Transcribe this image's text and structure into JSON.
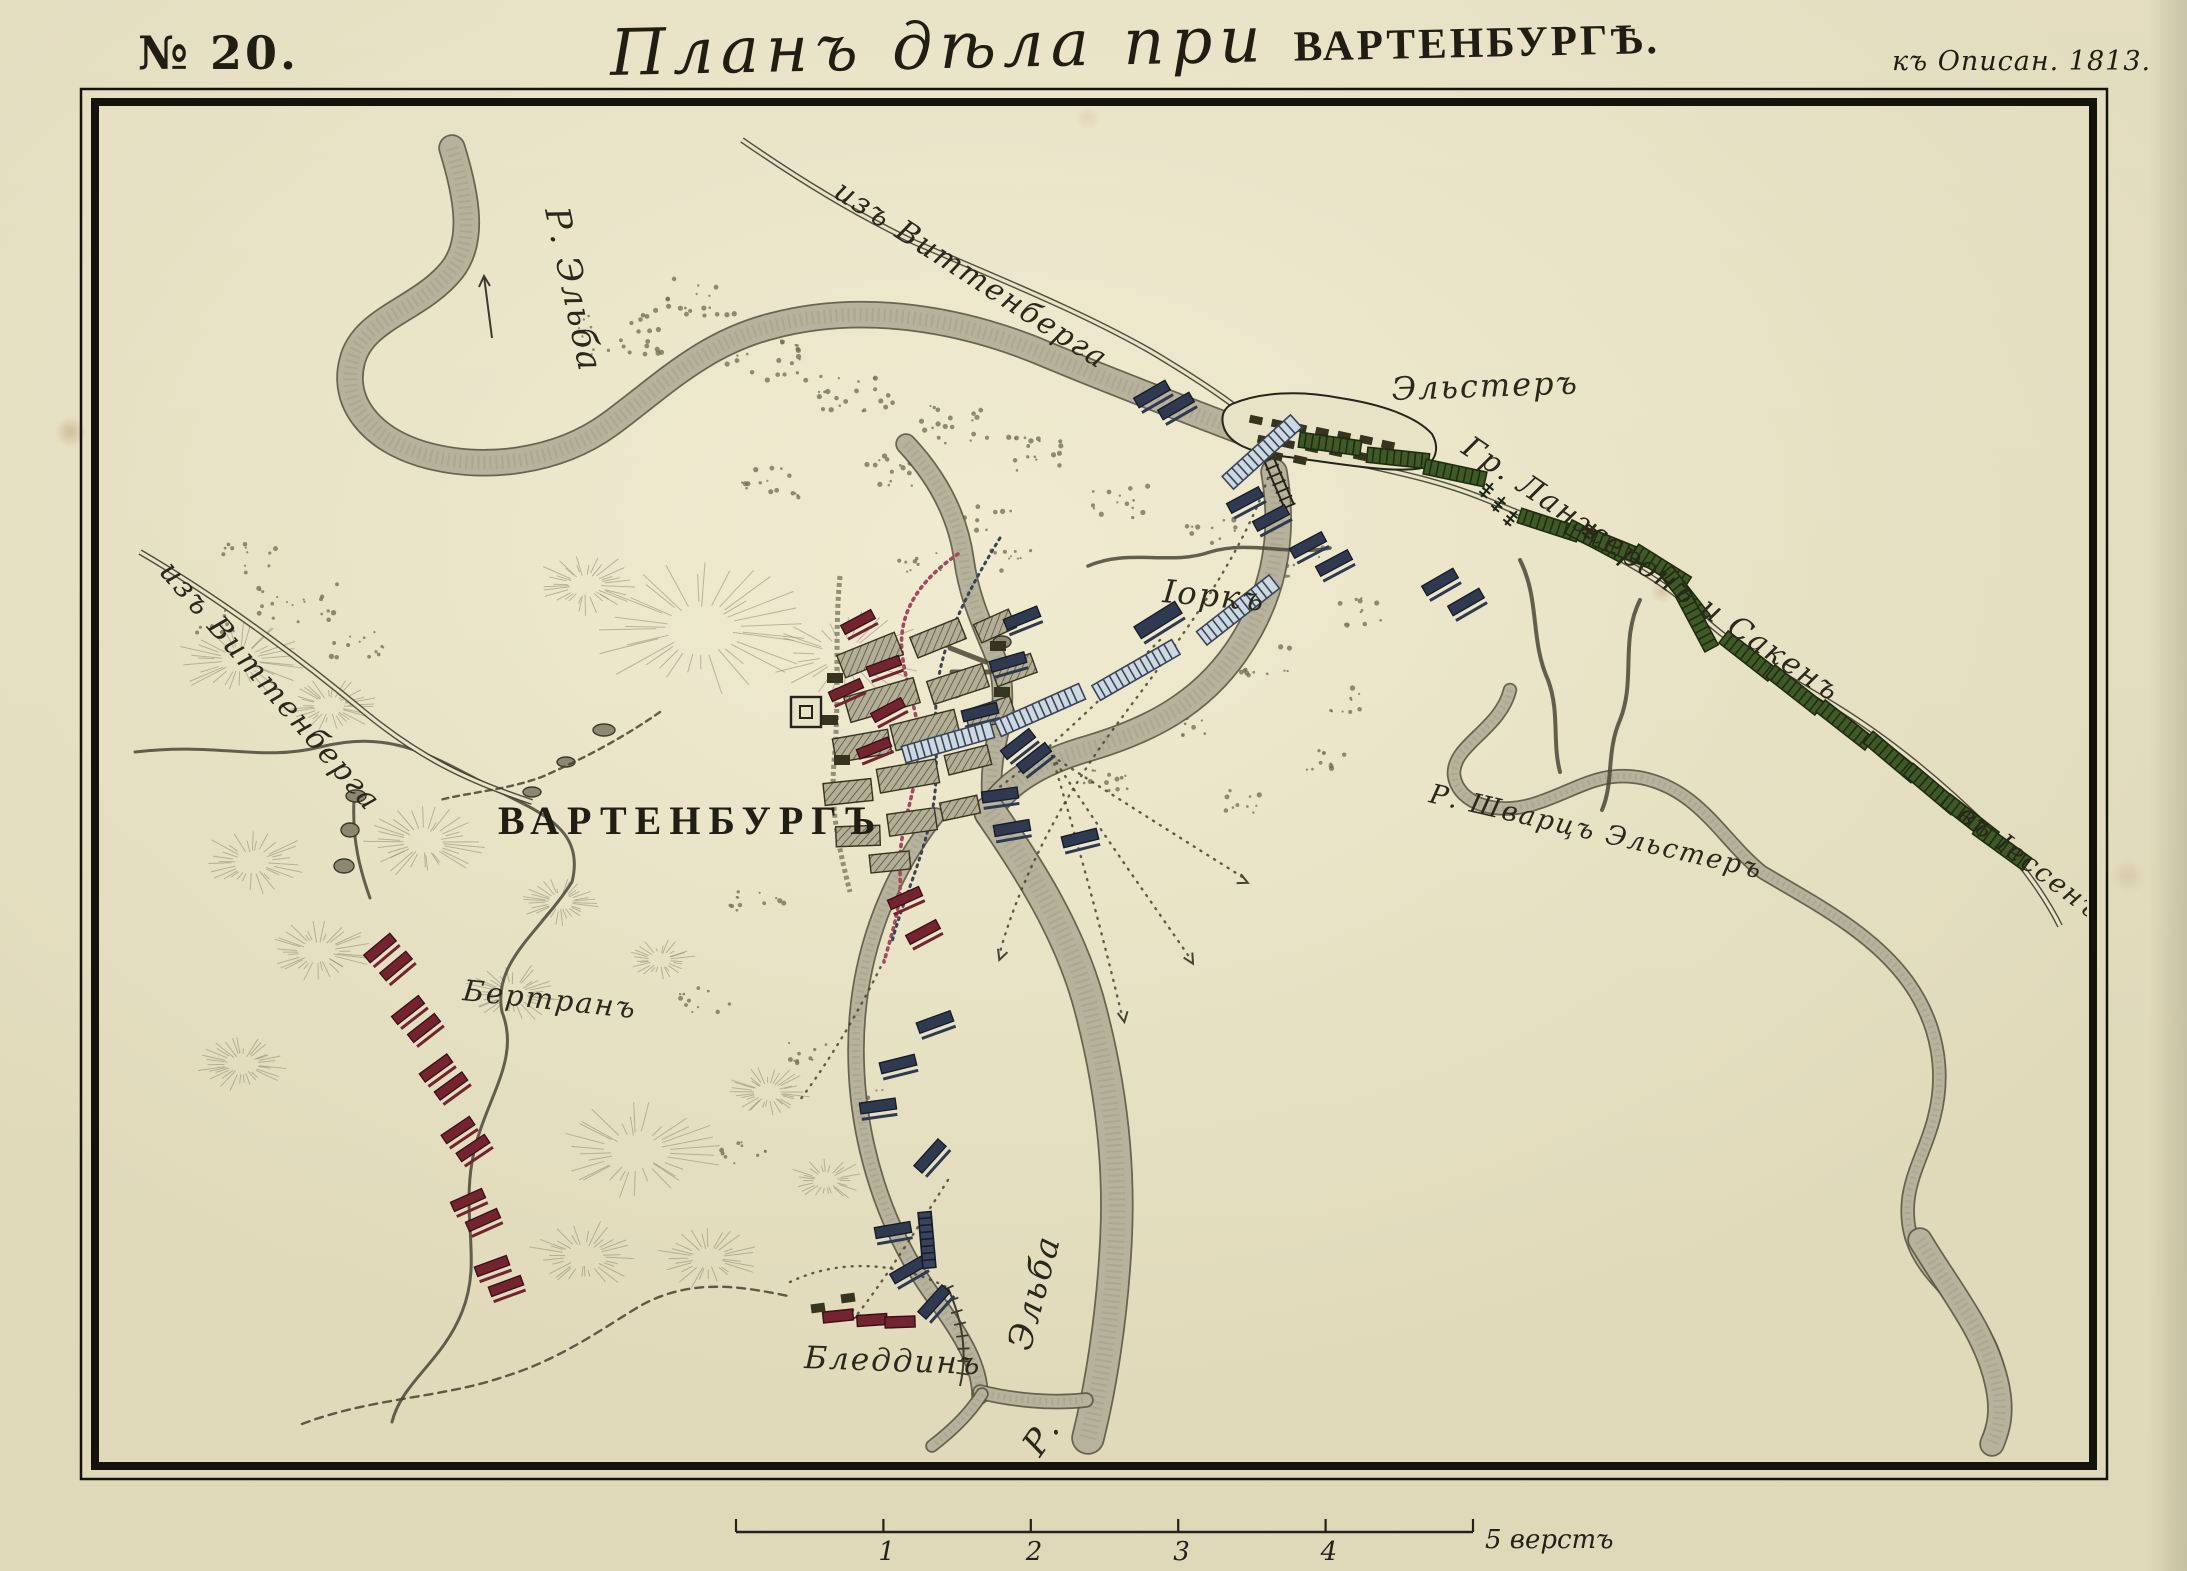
{
  "page": {
    "width": 2187,
    "height": 1571
  },
  "header": {
    "map_number": "№ 20.",
    "title_script": "Планъ дѣла при",
    "title_caps": "ВАРТЕНБУРГѢ.",
    "reference": "къ Описан. 1813."
  },
  "scale_bar": {
    "tick_labels": [
      "1",
      "2",
      "3",
      "4"
    ],
    "caption": "5 верстъ",
    "x0": 736,
    "x1": 1473,
    "y": 1532
  },
  "colors": {
    "paper": "#e8e3c7",
    "ink": "#26231a",
    "frame": "#14120c",
    "river_fill": "#b6b29b",
    "river_edge": "#595644",
    "river_texture": "#9d9982",
    "french": "#73242f",
    "french_edge": "#3a0f18",
    "allied": "#2f3950",
    "allied_edge": "#141a29",
    "column_light_fill": "#ccd9e0",
    "column_light_stripe": "#39445a",
    "column_green_fill": "#3f5a28",
    "column_green_stripe": "#1e2d0f",
    "hill": "#8d8871",
    "scrub": "#6e6b52",
    "road": "#3f3c2d",
    "red_dotted": "#a34b5c",
    "blue_dotted": "#3a4456",
    "entrench": "#7d7862",
    "building_hatch": "#b3af96",
    "building_dark": "#36331f"
  },
  "labels": [
    {
      "n": "road-from-wittenberg-top",
      "t": "изъ Виттенберга",
      "x": 832,
      "y": 196,
      "r": 33,
      "s": 30,
      "c": "lab-script"
    },
    {
      "n": "road-from-wittenberg-left",
      "t": "изъ Виттенберга",
      "x": 158,
      "y": 572,
      "r": 49,
      "s": 30,
      "c": "lab-script"
    },
    {
      "n": "river-elbe-northwest",
      "t": "Р. Эльба",
      "x": 545,
      "y": 210,
      "r": 78,
      "s": 34,
      "c": "lab-script"
    },
    {
      "n": "town-elster",
      "t": "Эльстеръ",
      "x": 1392,
      "y": 400,
      "r": -2,
      "s": 32,
      "c": "lab-script"
    },
    {
      "n": "corps-langeron-sacken",
      "t": "Гр. Ланжеронъ и Сакенъ",
      "x": 1460,
      "y": 452,
      "r": 34,
      "s": 30,
      "c": "lab-script"
    },
    {
      "n": "road-to-jessen",
      "t": "въ Іессенъ",
      "x": 1956,
      "y": 818,
      "r": 37,
      "s": 27,
      "c": "lab-script"
    },
    {
      "n": "river-schwarze-elster",
      "t": "Р. Шварцъ Эльстеръ",
      "x": 1428,
      "y": 802,
      "r": 13,
      "s": 27,
      "c": "lab-script"
    },
    {
      "n": "town-wartenburg",
      "t": "ВАРТЕНБУРГЪ",
      "x": 498,
      "y": 834,
      "r": 0,
      "s": 40,
      "c": "lab-caps"
    },
    {
      "n": "corps-bertrand",
      "t": "Бертранъ",
      "x": 462,
      "y": 1000,
      "r": 6,
      "s": 29,
      "c": "lab-script"
    },
    {
      "n": "corps-yorck",
      "t": "Іоркъ",
      "x": 1162,
      "y": 602,
      "r": 5,
      "s": 32,
      "c": "lab-script"
    },
    {
      "n": "town-bleddin",
      "t": "Бледдинъ",
      "x": 804,
      "y": 1368,
      "r": 2,
      "s": 31,
      "c": "lab-script"
    },
    {
      "n": "river-elbe-south",
      "t": "Эльба",
      "x": 1030,
      "y": 1352,
      "r": -75,
      "s": 34,
      "c": "lab-script"
    },
    {
      "n": "river-elbe-south-initial",
      "t": "Р.",
      "x": 1040,
      "y": 1458,
      "r": -55,
      "s": 34,
      "c": "lab-script"
    }
  ],
  "units": {
    "french": [
      [
        380,
        948,
        -40
      ],
      [
        396,
        966,
        -40
      ],
      [
        408,
        1010,
        -38
      ],
      [
        424,
        1028,
        -38
      ],
      [
        436,
        1068,
        -36
      ],
      [
        451,
        1086,
        -36
      ],
      [
        458,
        1130,
        -34
      ],
      [
        473,
        1148,
        -34
      ],
      [
        468,
        1200,
        -24
      ],
      [
        483,
        1220,
        -24
      ],
      [
        492,
        1266,
        -20
      ],
      [
        506,
        1286,
        -20
      ],
      [
        858,
        622,
        -28
      ],
      [
        884,
        666,
        -20
      ],
      [
        846,
        690,
        -24
      ],
      [
        888,
        710,
        -28
      ],
      [
        874,
        748,
        -22
      ],
      [
        905,
        898,
        -24
      ],
      [
        923,
        932,
        -28
      ]
    ],
    "allied": [
      [
        1152,
        394,
        -30
      ],
      [
        1176,
        406,
        -30
      ],
      [
        1245,
        500,
        -28
      ],
      [
        1271,
        518,
        -28
      ],
      [
        1308,
        545,
        -28
      ],
      [
        1334,
        563,
        -28
      ],
      [
        1440,
        582,
        -30
      ],
      [
        1466,
        602,
        -30
      ],
      [
        1158,
        620,
        -32,
        48,
        14
      ],
      [
        1022,
        618,
        -22
      ],
      [
        1008,
        662,
        -16
      ],
      [
        980,
        712,
        -14
      ],
      [
        1018,
        744,
        -38
      ],
      [
        1034,
        758,
        -38
      ],
      [
        1000,
        795,
        -8
      ],
      [
        1012,
        828,
        -10
      ],
      [
        1080,
        838,
        -14
      ],
      [
        935,
        1022,
        -20
      ],
      [
        898,
        1064,
        -14
      ],
      [
        878,
        1106,
        -8
      ],
      [
        930,
        1156,
        -48
      ],
      [
        893,
        1230,
        -10
      ],
      [
        908,
        1270,
        -30
      ],
      [
        934,
        1302,
        -48
      ]
    ],
    "light_columns": [
      [
        1262,
        452,
        -42
      ],
      [
        1238,
        610,
        -38
      ],
      [
        1136,
        670,
        -30
      ],
      [
        1040,
        710,
        -24
      ],
      [
        948,
        742,
        -16
      ]
    ],
    "dark_columns": [
      [
        927,
        1240,
        85,
        56,
        13
      ]
    ],
    "green_columns": [
      [
        1330,
        444,
        8
      ],
      [
        1398,
        458,
        6
      ],
      [
        1455,
        473,
        12
      ],
      [
        1549,
        525,
        18
      ],
      [
        1596,
        541,
        28
      ],
      [
        1624,
        550,
        22
      ],
      [
        1661,
        567,
        32
      ],
      [
        1685,
        595,
        52
      ],
      [
        1697,
        621,
        62
      ],
      [
        1748,
        656,
        38
      ],
      [
        1795,
        690,
        38
      ],
      [
        1845,
        725,
        38
      ],
      [
        1892,
        757,
        40
      ],
      [
        1932,
        789,
        40
      ],
      [
        1970,
        819,
        38
      ],
      [
        2002,
        846,
        36
      ]
    ]
  },
  "crosses": [
    [
      1487,
      490
    ],
    [
      1499,
      504
    ],
    [
      1511,
      518
    ],
    [
      1590,
      531
    ]
  ],
  "hills": [
    [
      700,
      628,
      115
    ],
    [
      845,
      655,
      85
    ],
    [
      585,
      585,
      55
    ],
    [
      240,
      660,
      65
    ],
    [
      330,
      706,
      48
    ],
    [
      252,
      862,
      58
    ],
    [
      424,
      842,
      62
    ],
    [
      318,
      952,
      55
    ],
    [
      512,
      994,
      52
    ],
    [
      242,
      1064,
      46
    ],
    [
      636,
      1152,
      88
    ],
    [
      584,
      1256,
      60
    ],
    [
      708,
      1258,
      52
    ],
    [
      768,
      1092,
      44
    ],
    [
      826,
      1180,
      40
    ],
    [
      560,
      902,
      40
    ],
    [
      660,
      960,
      36
    ]
  ],
  "scrub": [
    [
      618,
      330,
      45,
      25,
      26
    ],
    [
      700,
      298,
      35,
      20,
      18
    ],
    [
      766,
      362,
      40,
      22,
      22
    ],
    [
      854,
      392,
      42,
      22,
      22
    ],
    [
      948,
      424,
      40,
      20,
      20
    ],
    [
      1044,
      452,
      36,
      20,
      18
    ],
    [
      886,
      470,
      30,
      16,
      14
    ],
    [
      772,
      482,
      34,
      18,
      16
    ],
    [
      982,
      520,
      30,
      16,
      14
    ],
    [
      1118,
      502,
      30,
      16,
      14
    ],
    [
      1210,
      532,
      26,
      14,
      12
    ],
    [
      1296,
      562,
      30,
      16,
      14
    ],
    [
      1356,
      612,
      26,
      14,
      12
    ],
    [
      1262,
      660,
      30,
      16,
      14
    ],
    [
      1184,
      722,
      28,
      15,
      12
    ],
    [
      1106,
      782,
      28,
      15,
      12
    ],
    [
      1240,
      800,
      24,
      13,
      10
    ],
    [
      1322,
      762,
      24,
      13,
      10
    ],
    [
      756,
      902,
      28,
      15,
      12
    ],
    [
      706,
      1002,
      26,
      14,
      11
    ],
    [
      802,
      1052,
      24,
      13,
      10
    ],
    [
      744,
      1152,
      24,
      13,
      10
    ],
    [
      298,
      600,
      40,
      22,
      20
    ],
    [
      252,
      560,
      30,
      16,
      12
    ],
    [
      356,
      642,
      30,
      16,
      13
    ],
    [
      210,
      620,
      24,
      13,
      10
    ],
    [
      1012,
      560,
      24,
      13,
      10
    ],
    [
      920,
      560,
      22,
      12,
      9
    ],
    [
      1340,
      700,
      22,
      12,
      9
    ],
    [
      876,
      1102,
      22,
      12,
      9
    ]
  ],
  "ponds": [
    [
      356,
      796,
      10,
      6
    ],
    [
      350,
      830,
      9,
      7
    ],
    [
      344,
      866,
      10,
      7
    ],
    [
      604,
      730,
      11,
      6
    ],
    [
      566,
      762,
      9,
      5
    ],
    [
      532,
      792,
      9,
      5
    ],
    [
      1002,
      642,
      9,
      6
    ]
  ],
  "towns": {
    "wartenburg": {
      "buildings": [
        [
          870,
          655,
          62,
          24,
          -22
        ],
        [
          938,
          638,
          52,
          22,
          -22
        ],
        [
          995,
          626,
          38,
          20,
          -24
        ],
        [
          882,
          700,
          72,
          26,
          -16
        ],
        [
          958,
          684,
          58,
          24,
          -18
        ],
        [
          1014,
          670,
          42,
          20,
          -20
        ],
        [
          862,
          746,
          56,
          24,
          -10
        ],
        [
          925,
          730,
          66,
          26,
          -14
        ],
        [
          990,
          714,
          48,
          22,
          -18
        ],
        [
          848,
          792,
          48,
          22,
          -6
        ],
        [
          908,
          776,
          60,
          24,
          -10
        ],
        [
          968,
          760,
          44,
          20,
          -14
        ],
        [
          858,
          836,
          44,
          20,
          -2
        ],
        [
          912,
          822,
          48,
          22,
          -8
        ],
        [
          960,
          808,
          38,
          18,
          -12
        ],
        [
          890,
          862,
          40,
          18,
          -6
        ]
      ],
      "solid": [
        [
          835,
          678
        ],
        [
          830,
          720
        ],
        [
          842,
          760
        ],
        [
          998,
          646
        ],
        [
          1002,
          692
        ]
      ],
      "symbol": [
        806,
        712
      ]
    },
    "elster": {
      "outline": "M 1232,404 C 1260,392 1300,390 1340,398 C 1380,404 1416,416 1432,434 C 1440,448 1436,462 1422,468 C 1390,474 1330,462 1280,456 C 1250,452 1230,444 1224,428 C 1220,416 1224,408 1232,404 Z",
      "houses": [
        [
          1256,
          420,
          12
        ],
        [
          1278,
          424,
          12
        ],
        [
          1300,
          428,
          12
        ],
        [
          1322,
          432,
          12
        ],
        [
          1344,
          436,
          12
        ],
        [
          1366,
          440,
          12
        ],
        [
          1388,
          445,
          12
        ],
        [
          1264,
          440,
          12
        ],
        [
          1288,
          444,
          12
        ],
        [
          1312,
          448,
          12
        ],
        [
          1336,
          452,
          12
        ],
        [
          1360,
          456,
          12
        ],
        [
          1276,
          456,
          12
        ],
        [
          1300,
          460,
          12
        ]
      ]
    },
    "bleddin": {
      "houses_red": [
        [
          838,
          1316,
          -6
        ],
        [
          872,
          1320,
          -4
        ],
        [
          900,
          1322,
          -2
        ]
      ],
      "houses_dark": [
        [
          818,
          1308,
          -8
        ],
        [
          848,
          1298,
          -8
        ]
      ]
    }
  }
}
